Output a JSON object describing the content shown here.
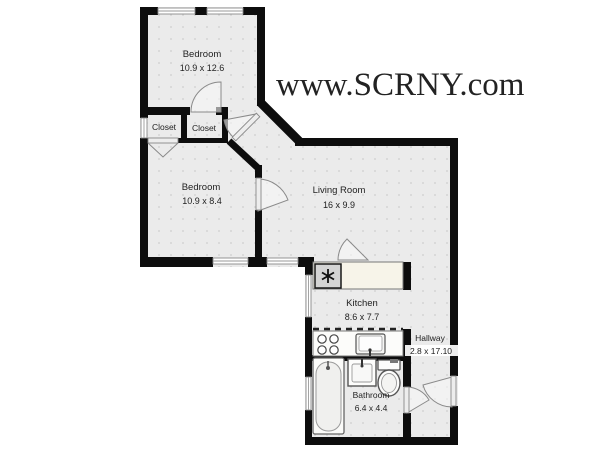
{
  "watermark": {
    "text": "www.SCRNY.com",
    "color": "#b0342c"
  },
  "palette": {
    "wall": "#0d0d0d",
    "floor": "#ebebeb",
    "floor_dot": "#cfcfcf",
    "window_line": "#8a8a8a",
    "counter": "#f7f4e9",
    "appliance": "#d4d4d4",
    "fixture_outline": "#555555",
    "watermark_red": "#b0342c"
  },
  "rooms": {
    "bedroom1": {
      "name": "Bedroom",
      "dims": "10.9 x 12.6"
    },
    "bedroom2": {
      "name": "Bedroom",
      "dims": "10.9 x 8.4"
    },
    "living_room": {
      "name": "Living Room",
      "dims": "16 x 9.9"
    },
    "kitchen": {
      "name": "Kitchen",
      "dims": "8.6 x 7.7"
    },
    "hallway": {
      "name": "Hallway",
      "dims": "2.8 x 17.10"
    },
    "bathroom": {
      "name": "Bathroom",
      "dims": "6.4 x 4.4"
    },
    "closet_left": {
      "name": "Closet"
    },
    "closet_right": {
      "name": "Closet"
    }
  },
  "fixtures": {
    "kitchen": [
      "counter",
      "appliance-asterisk",
      "stove-4-burner",
      "sink",
      "upper-cabinet-dashed"
    ],
    "bathroom": [
      "bathtub",
      "sink",
      "toilet"
    ]
  }
}
